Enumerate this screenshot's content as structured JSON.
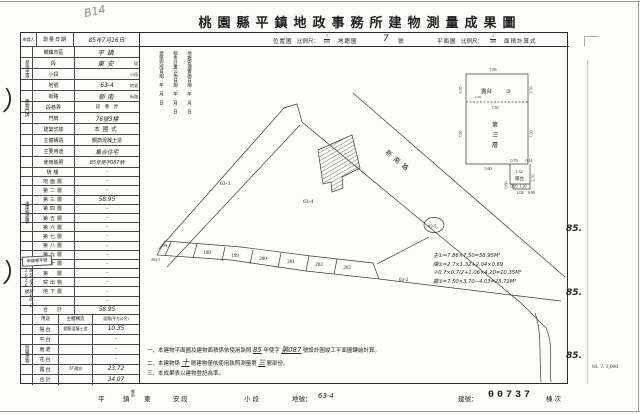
{
  "title": "桃園縣平鎮地政事務所建物測量成果圖",
  "marks": {
    "pencil": "B14",
    "pen": "）",
    "margin_85_1": "85.",
    "margin_85_2": "85.",
    "margin_85_3": "85.",
    "print_info": "84. 7. 3,000"
  },
  "header": {
    "applicant": "申請人",
    "survey_date_label": "測量日期",
    "survey_date": "85年7月16日",
    "location_map": "位置圖",
    "scale_label": "比例尺：",
    "loc_num": "1",
    "loc_den": "600",
    "cadastral": "地籍圖",
    "sheet_no": "7",
    "sheet_unit": "號",
    "plan": "平面圖",
    "plan_num": "1",
    "plan_den": "200",
    "area_calc": "面積計算式"
  },
  "site": {
    "group": "基地坐落",
    "rows": [
      {
        "label": "鄉鎮市區",
        "value": "平鎮",
        "suffix": ""
      },
      {
        "label": "段",
        "value": "東安",
        "suffix": "段"
      },
      {
        "label": "小段",
        "value": "",
        "suffix": "小段"
      },
      {
        "label": "地號",
        "value": "63-4",
        "suffix": "地號"
      }
    ]
  },
  "door": {
    "group": "建物門牌",
    "rows": [
      {
        "label": "街路",
        "value": "新南",
        "suffix": "街路"
      },
      {
        "label": "段巷弄",
        "value": "",
        "suffix": "段　巷　弄"
      },
      {
        "label": "門牌",
        "value": "76號3樓",
        "suffix": ""
      }
    ]
  },
  "attrs": [
    {
      "label": "建築式樣",
      "value": "本國式"
    },
    {
      "label": "主體構造",
      "value": "鋼筋混凝土造"
    },
    {
      "label": "主要用途",
      "value": "集合住宅"
    },
    {
      "label": "使用執照",
      "value": "85年使字087號"
    }
  ],
  "floors": {
    "group": "主建物面積",
    "rows": [
      {
        "label": "騎樓",
        "value": "·"
      },
      {
        "label": "地面層",
        "value": "·"
      },
      {
        "label": "第二層",
        "value": "·"
      },
      {
        "label": "第三層",
        "value": "58.95"
      },
      {
        "label": "第四層",
        "value": "·"
      },
      {
        "label": "第五層",
        "value": "·"
      },
      {
        "label": "第六層",
        "value": "·"
      },
      {
        "label": "第七層",
        "value": "·"
      },
      {
        "label": "第八層",
        "value": "·"
      },
      {
        "label": "第九層",
        "value": "·"
      },
      {
        "label": "第十層",
        "value": "·"
      },
      {
        "label": "第　層",
        "value": "·"
      },
      {
        "label": "突出物",
        "value": "·"
      },
      {
        "label": "地下層",
        "value": "·"
      },
      {
        "label": "",
        "value": "·"
      },
      {
        "label": "合　計",
        "value": "58.95"
      }
    ]
  },
  "application": {
    "box": "申請書字號",
    "number": "85年7月16日1016號"
  },
  "annex": {
    "group": "附屬建物",
    "use_h": "用途",
    "structure_h": "主體構造",
    "area_h": "面積(平方公尺)",
    "rows": [
      {
        "label": "陽台",
        "structure": "鋼筋混凝土造",
        "area": "10.35"
      },
      {
        "label": "平台",
        "structure": "",
        "area": "·"
      },
      {
        "label": "雨遮",
        "structure": "",
        "area": "·"
      },
      {
        "label": "花台",
        "structure": "",
        "area": "·"
      },
      {
        "label": "露台",
        "structure": "7F陽台",
        "area": "23.72"
      },
      {
        "label": "合計",
        "structure": "",
        "area": "34.07"
      }
    ]
  },
  "map": {
    "annotations": [
      "建築完成日期：年　月　日",
      "都市計畫公佈日期：年　月　日",
      "地籍管理實施日期：年　月　日"
    ],
    "road": "新南路",
    "lots": {
      "l63_3": "63-3",
      "l63_4": "63-4",
      "l63_2": "63-2",
      "l63_5": "63-5",
      "l198_1": "198-1",
      "l204_1": "204-1"
    },
    "houses": [
      "198",
      "199",
      "200",
      "201",
      "202",
      "203"
    ]
  },
  "inset": {
    "d_top": "7.86",
    "d_mid": "7.50",
    "d_left_top": "3.70",
    "d_right_top": "3.70",
    "d_left": "7.50",
    "d_right": "7.50",
    "d_bottom": "5.60",
    "d_a1": "0.70",
    "d_a2": "0.14",
    "d_a3": "2.70",
    "d_a4": "1.32",
    "d_a5": "0.20",
    "d_a6": "1.20",
    "d_a7": "0.60",
    "d_a8": "2.04",
    "d_a9": "0.69",
    "d_n1": "1.05",
    "terrace": "露台",
    "c3": "③",
    "f1": "第",
    "f2": "三",
    "f3": "層",
    "balcony": "陽台"
  },
  "calc": {
    "l1": "主①=7.86×7.50=58.95M²",
    "l2": "陽②=2.7×1.32+2.04×0.69",
    "l3": "＋0.7×0.7/2+1.06×4.20=10.35M²",
    "l4": "露③=7.50×3.70−4.03=23.72M²"
  },
  "notes": {
    "n1a": "一、本建物平面圖及建物面積係依使用執照",
    "n1b": "85",
    "n1c": "年使字",
    "n1d": "第087",
    "n1e": "號設計圖竣工平面圖轉繪計算。",
    "n2a": "二、本建物係",
    "n2b": "十",
    "n2c": "層建物僅依使用執照測量第",
    "n2d": "三",
    "n2e": "層部份。",
    "n3": "三、本成果表以建物登記為準。"
  },
  "footer": {
    "town": "平　鎮",
    "stack1": "鄉",
    "stack2": "市",
    "section": "東　安",
    "sec_suffix": "段",
    "small": "小段",
    "lot_label": "地號：",
    "lot": "63-4",
    "bldg_label": "建號：",
    "bldg": "00737",
    "seq": "棟次"
  }
}
